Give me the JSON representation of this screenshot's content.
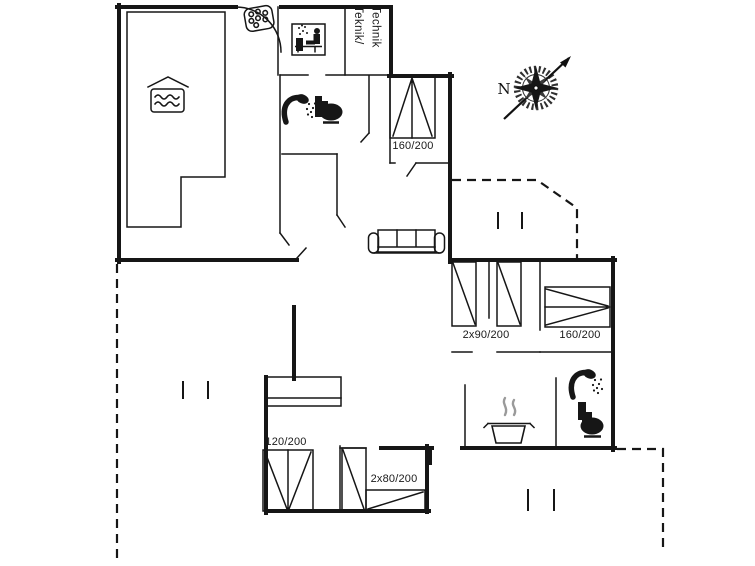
{
  "plan_title": "Holiday home floor plan",
  "labels": {
    "bed_top_double": "160/200",
    "bed_twin_right": "2x90/200",
    "bed_right_double": "160/200",
    "bed_bottom_single": "120/200",
    "bed_bottom_twin": "2x80/200",
    "technical_room_line1": "Teknik/",
    "technical_room_line2": "Technik",
    "compass_north": "N"
  },
  "icons": [
    "swimming-pool-icon",
    "entrance-shower-icon",
    "sauna-icon",
    "shower-icon",
    "toilet-icon",
    "sofa-icon",
    "stove-pot-icon",
    "compass-rose-icon",
    "wardrobe",
    "door-arc",
    "window-marks"
  ],
  "colors": {
    "wall": "#161616",
    "steam": "#9a9a9a",
    "background": "#ffffff"
  }
}
